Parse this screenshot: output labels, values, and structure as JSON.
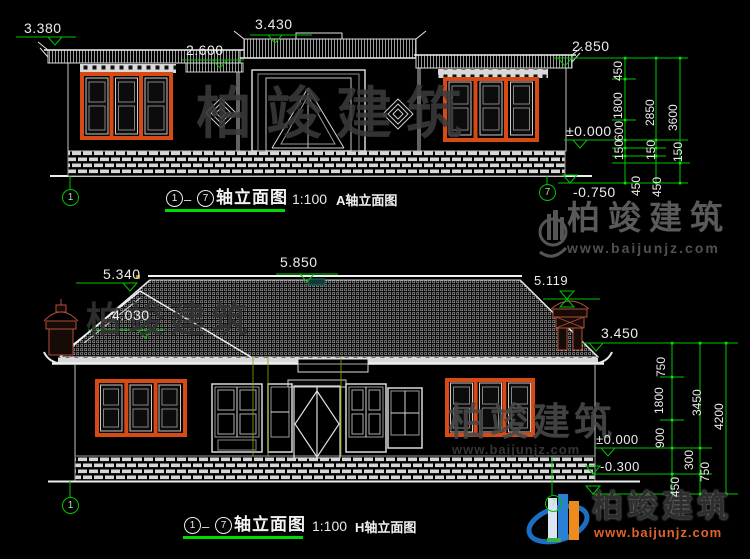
{
  "watermark": {
    "brand": "柏竣建筑",
    "site": "www.baijunjz.com"
  },
  "top": {
    "axis_start": "1",
    "axis_end": "7",
    "dash": "–",
    "title": "轴立面图",
    "scale": "1:100",
    "subtitle": "A轴立面图",
    "elev": {
      "left_tip": "3.380",
      "left_eave": "2.600",
      "gate_ridge": "3.430",
      "right_eave": "2.850",
      "floor": "±0.000",
      "ground": "-0.750"
    },
    "dims": {
      "col1": [
        "450",
        "1800",
        "600",
        "150",
        "450"
      ],
      "col2": [
        "2850",
        "150",
        "450"
      ],
      "col3": [
        "3600",
        "150"
      ]
    }
  },
  "bottom": {
    "axis_start": "1",
    "axis_end": "7",
    "dash": "–",
    "title": "轴立面图",
    "scale": "1:100",
    "subtitle": "H轴立面图",
    "elev": {
      "left_ridge": "5.340",
      "main_ridge": "5.850",
      "left_slope": "4.030",
      "chimney_top": "5.119",
      "eave": "3.450",
      "floor": "±0.000",
      "plinth": "-0.300"
    },
    "dims": {
      "col1": [
        "750",
        "1800",
        "900",
        "300",
        "450"
      ],
      "col2": [
        "3450",
        "750"
      ],
      "col3": [
        "4200"
      ]
    }
  }
}
